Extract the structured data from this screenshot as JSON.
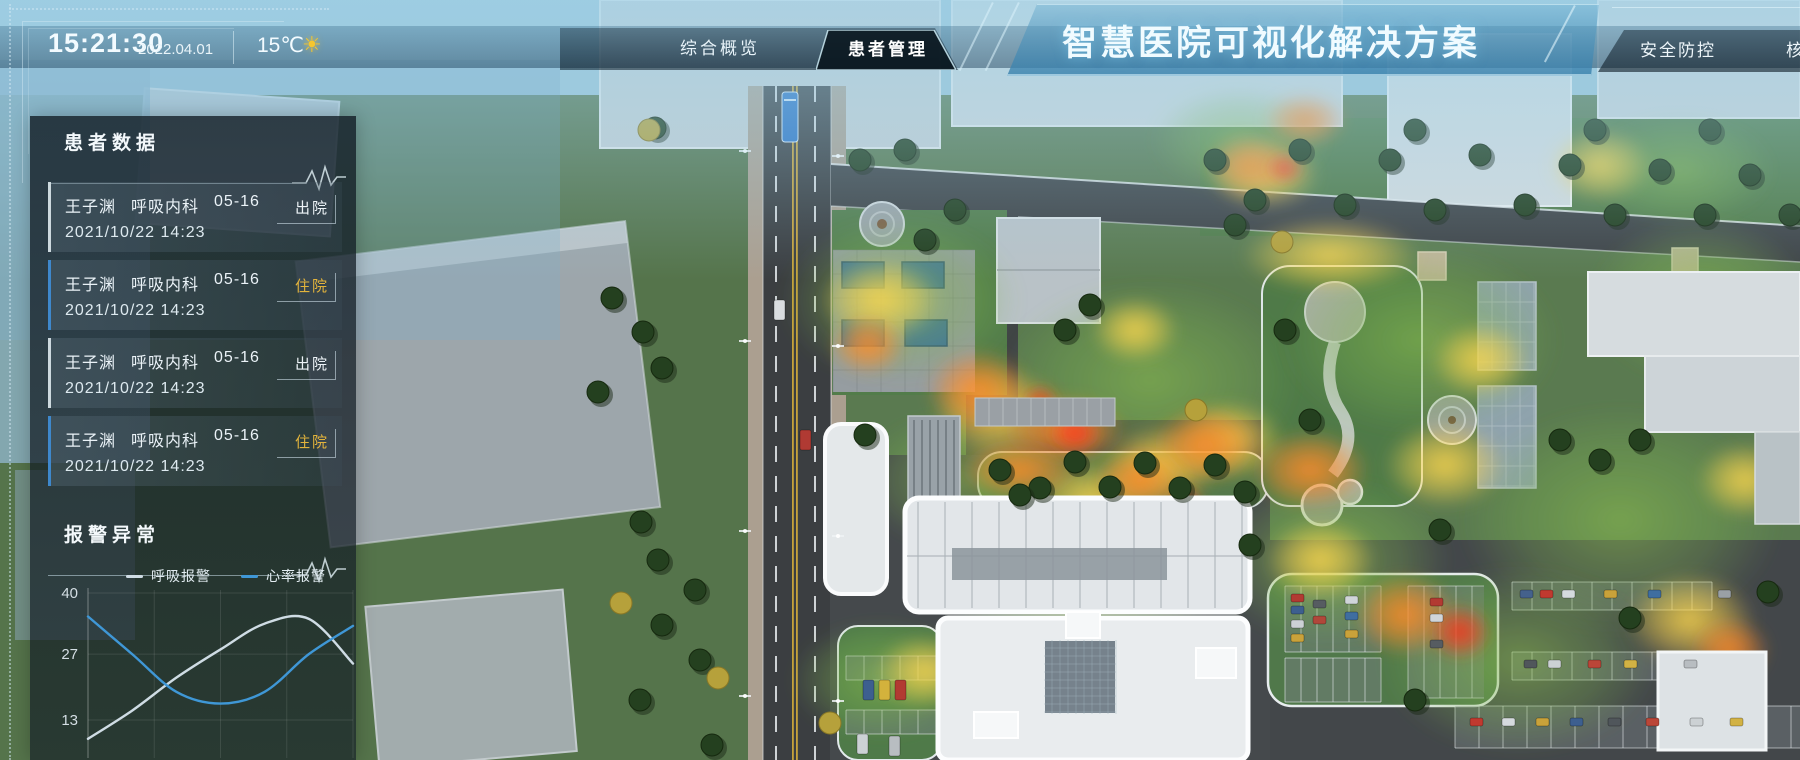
{
  "header": {
    "time": "15:21:30",
    "date": "2022.04.01",
    "weather": {
      "temperature": "15℃",
      "icon": "sun-icon",
      "glyph": "☀"
    },
    "nav_tabs": [
      {
        "label": "综合概览",
        "active": false
      },
      {
        "label": "患者管理",
        "active": true
      }
    ],
    "title": "智慧医院可视化解决方案",
    "right_tabs": [
      {
        "label": "安全防控",
        "active": false
      },
      {
        "label": "核",
        "active": false,
        "truncated": true
      }
    ]
  },
  "patient_panel": {
    "title": "患者数据",
    "items": [
      {
        "name": "王子渊",
        "department": "呼吸内科",
        "bed": "05-16",
        "datetime": "2021/10/22 14:23",
        "status": "出院",
        "status_type": "discharged"
      },
      {
        "name": "王子渊",
        "department": "呼吸内科",
        "bed": "05-16",
        "datetime": "2021/10/22 14:23",
        "status": "住院",
        "status_type": "hospitalized"
      },
      {
        "name": "王子渊",
        "department": "呼吸内科",
        "bed": "05-16",
        "datetime": "2021/10/22 14:23",
        "status": "出院",
        "status_type": "discharged"
      },
      {
        "name": "王子渊",
        "department": "呼吸内科",
        "bed": "05-16",
        "datetime": "2021/10/22 14:23",
        "status": "住院",
        "status_type": "hospitalized"
      }
    ]
  },
  "alarm_panel": {
    "title": "报警异常"
  },
  "chart_data": {
    "type": "line",
    "title": "报警异常",
    "x": [
      0,
      1,
      2,
      3,
      4,
      5,
      6
    ],
    "series": [
      {
        "name": "呼吸报警",
        "color": "#cfdce4",
        "values": [
          9,
          15,
          22,
          28,
          33.5,
          34.5,
          25
        ]
      },
      {
        "name": "心率报警",
        "color": "#3f97d6",
        "values": [
          35,
          27,
          19,
          16.5,
          19,
          27,
          33
        ]
      }
    ],
    "yticks": [
      40,
      27,
      13
    ],
    "ylim": [
      0,
      40
    ],
    "xlabels_visible": false,
    "grid": true,
    "legend_position": "top"
  },
  "colors": {
    "accent_blue": "#3e88cc",
    "status_discharged": "#edf3f7",
    "status_hospitalized": "#e2b33c",
    "title_text": "#f0fbff",
    "sun_yellow": "#f5c62e"
  }
}
